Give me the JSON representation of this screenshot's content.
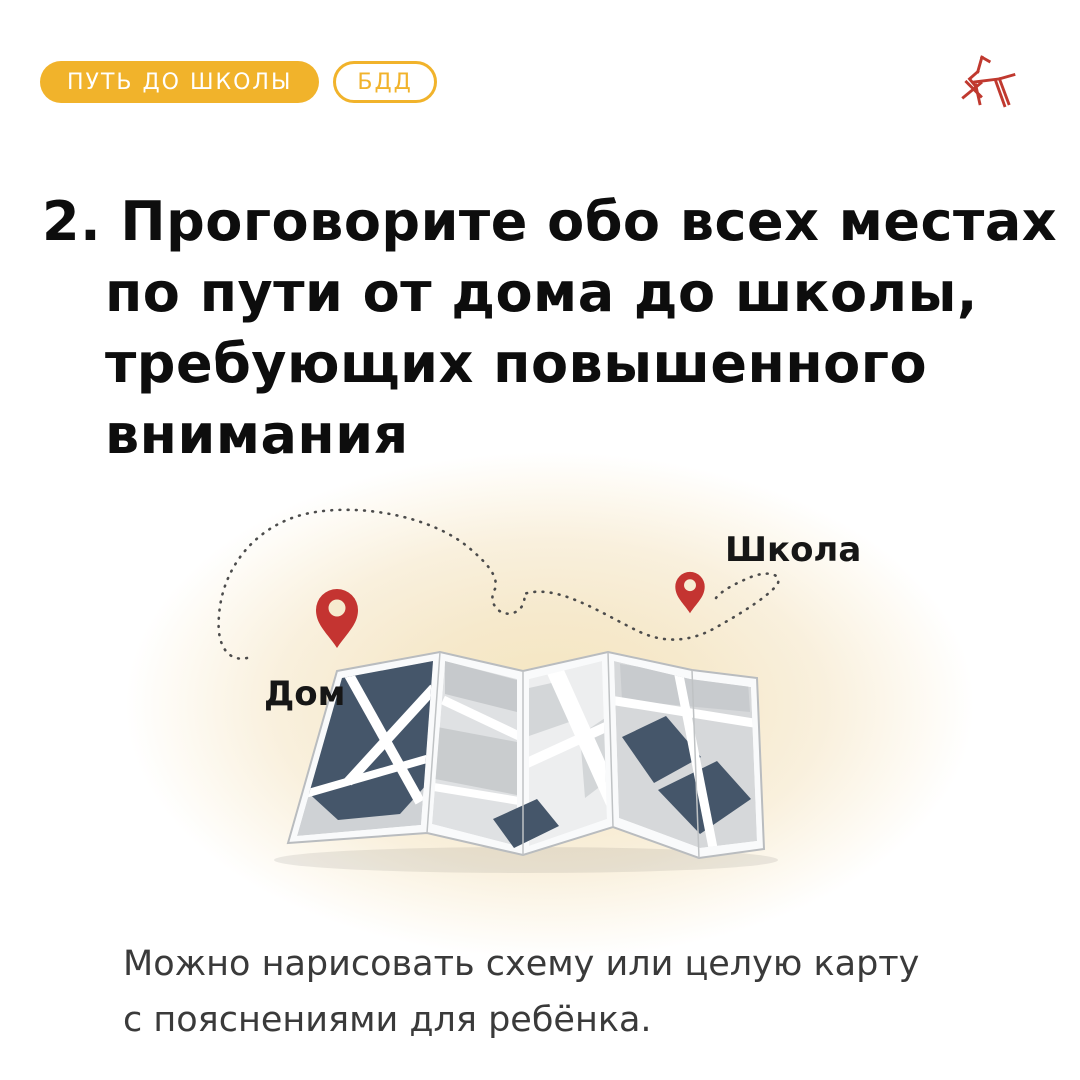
{
  "header": {
    "badges": [
      {
        "label": "ПУТЬ ДО ШКОЛЫ",
        "style": "filled"
      },
      {
        "label": "БДД",
        "style": "outline"
      }
    ],
    "logo_icon": "horse-sketch-icon"
  },
  "heading": {
    "lines": [
      "2. Проговорите обо всех местах",
      "по пути от дома до школы,",
      "требующих повышенного",
      "внимания"
    ]
  },
  "illustration": {
    "home_label": "Дом",
    "school_label": "Школа",
    "type": "folded-city-map-with-dotted-route-between-pins"
  },
  "caption": {
    "lines": [
      "Можно нарисовать схему или целую карту",
      "с пояснениями для ребёнка."
    ]
  },
  "colors": {
    "accent_yellow": "#f1b32b",
    "pin_red": "#c43431",
    "logo_red": "#c0392f",
    "map_dark": "#45566a",
    "glow_cream": "#f4e5bf",
    "heading_text": "#0d0d0d",
    "caption_text": "#3a3a3a"
  }
}
